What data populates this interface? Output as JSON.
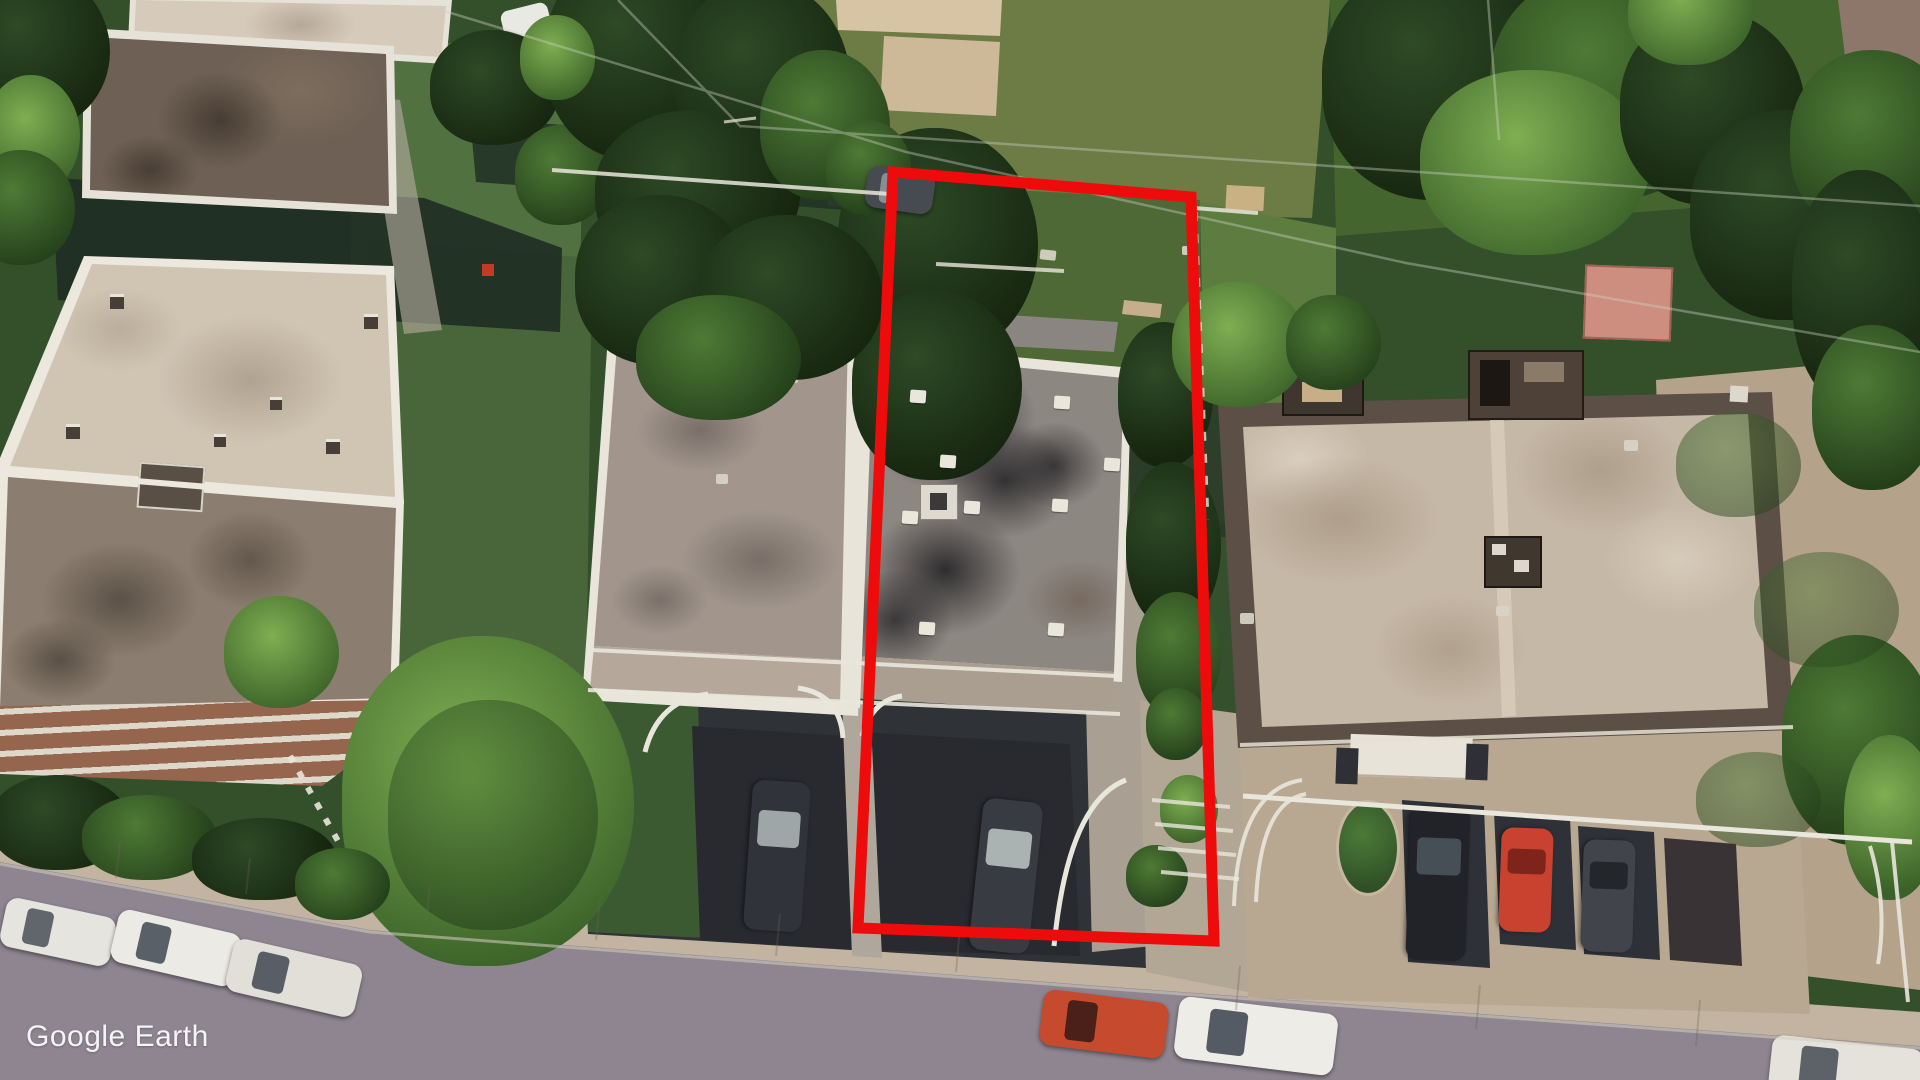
{
  "app": {
    "name": "Google Earth",
    "watermark": "Google Earth"
  },
  "map": {
    "view": "oblique satellite aerial",
    "scene": "residential block: three flat-roof apartment houses, backyards with trees, front driveways with parked cars, diagonal street with curb parking"
  },
  "annotations": {
    "parcel_outline": {
      "points": "893,172 1191,197 1214,941 858,928",
      "color": "#ee0b0b",
      "width": 11,
      "meaning": "highlighted property lot"
    }
  },
  "palette": {
    "grass": "#33502b",
    "street": "#8e8590",
    "sidewalk": "#c2b4a0",
    "asphalt": "#282a30",
    "concrete": "#aca28f",
    "roof-cream": "#d3c7b6",
    "roof-taupe": "#8b7d6f",
    "roof-dark-brown": "#6e6054",
    "duplex-roof-left": "#a1958c",
    "duplex-roof-right": "#8d8782",
    "tar-patch": "#232327",
    "right-roof-tan": "#c6b8a6",
    "right-roof-border": "#5c5046",
    "brick": "#96654e",
    "tree-dark": "#22391b",
    "tree-mid": "#3c6030",
    "tree-bright": "#6fa14b",
    "watermark-text": "#ffffff"
  },
  "scene": {
    "cars": [
      {
        "name": "white-car-street-left-1",
        "cx": 58,
        "cy": 932,
        "len": 112,
        "wid": 50,
        "angle": 12,
        "body": "#e6e4de",
        "glass": "#61666d"
      },
      {
        "name": "white-car-street-left-2",
        "cx": 176,
        "cy": 948,
        "len": 126,
        "wid": 54,
        "angle": 13,
        "body": "#eceae4",
        "glass": "#5a6068"
      },
      {
        "name": "white-car-street-left-3",
        "cx": 294,
        "cy": 978,
        "len": 132,
        "wid": 54,
        "angle": 13,
        "body": "#e2dfd8",
        "glass": "#585e66"
      },
      {
        "name": "red-car-street-center",
        "cx": 1104,
        "cy": 1024,
        "len": 126,
        "wid": 56,
        "angle": 7,
        "body": "#c64a2e",
        "glass": "#4a2018"
      },
      {
        "name": "white-car-street-center",
        "cx": 1256,
        "cy": 1036,
        "len": 160,
        "wid": 62,
        "angle": 7,
        "body": "#eeece6",
        "glass": "#555b64"
      },
      {
        "name": "white-car-street-right-partial",
        "cx": 1846,
        "cy": 1070,
        "len": 152,
        "wid": 56,
        "angle": 6,
        "body": "#e4e2da",
        "glass": "#5d6269"
      },
      {
        "name": "dark-car-left-duplex-driveway",
        "cx": 777,
        "cy": 856,
        "len": 150,
        "wid": 58,
        "angle": 94,
        "body": "#30333a",
        "glass": "#9fa6a8"
      },
      {
        "name": "dark-car-parcel-driveway",
        "cx": 1006,
        "cy": 876,
        "len": 152,
        "wid": 60,
        "angle": 96,
        "body": "#383b42",
        "glass": "#aab3b2"
      },
      {
        "name": "black-suv-right-building",
        "cx": 1438,
        "cy": 884,
        "len": 152,
        "wid": 60,
        "angle": 92,
        "body": "#212328",
        "glass": "#464e56"
      },
      {
        "name": "red-car-right-building",
        "cx": 1526,
        "cy": 880,
        "len": 104,
        "wid": 52,
        "angle": 92,
        "body": "#c8422f",
        "glass": "#7e241a"
      },
      {
        "name": "gray-car-right-building",
        "cx": 1608,
        "cy": 896,
        "len": 112,
        "wid": 52,
        "angle": 92,
        "body": "#41444b",
        "glass": "#23262b"
      },
      {
        "name": "dark-vehicle-back-alley",
        "cx": 900,
        "cy": 190,
        "len": 68,
        "wid": 42,
        "angle": 8,
        "body": "#454b50",
        "glass": "#888f94"
      }
    ],
    "parcel_roof_vents": [
      [
        918,
        396
      ],
      [
        1062,
        402
      ],
      [
        948,
        461
      ],
      [
        972,
        507
      ],
      [
        910,
        517
      ],
      [
        1060,
        505
      ],
      [
        927,
        628
      ],
      [
        1056,
        629
      ],
      [
        1112,
        464
      ]
    ]
  }
}
